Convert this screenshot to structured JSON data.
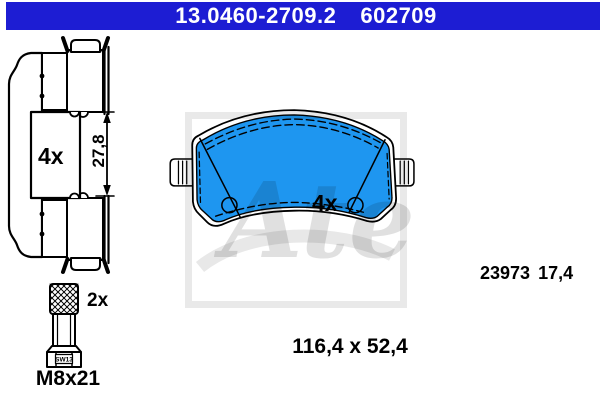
{
  "header": {
    "part_number": "13.0460-2709.2",
    "reference_number": "602709",
    "background_color": "#1d1dd3",
    "text_color": "#ffffff"
  },
  "side_view": {
    "quantity_label": "4x",
    "height_dimension": "27,8"
  },
  "front_view": {
    "quantity_label": "4x",
    "wva_number": "23973",
    "thickness": "17,4",
    "pad_color": "#1e96f0"
  },
  "footer": {
    "dimensions_label": "116,4 x 52,4"
  },
  "bolt": {
    "quantity_label": "2x",
    "size_label": "M8x21",
    "wrench_size_label": "SW13"
  },
  "watermark": {
    "brand": "Ate",
    "color": "#e3e3e3"
  }
}
